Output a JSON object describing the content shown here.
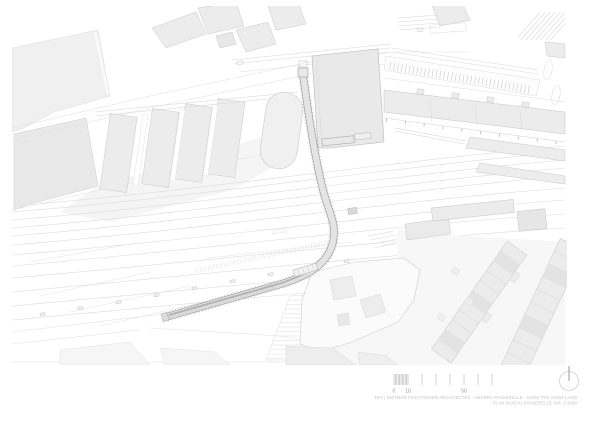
{
  "captions": {
    "line1": "DFA |  DIETMAR FEICHTINGER ARCHITECTES - ANGERS PASSERELLE - GARE TGV SAINT LAUD",
    "line2": "PLAN NIVEAU PASSERELLE éch. 1/1000"
  },
  "scale_bar": {
    "label_0": "0",
    "label_10": "10",
    "label_50": "50",
    "unit": "m"
  },
  "icons": {
    "north_indicator": "circle-with-needle"
  },
  "plan_features": [
    "passerelle footbridge with curved ramp",
    "railway tracks fanning through station",
    "station platforms",
    "station buildings",
    "parking areas with stall hatching",
    "urban housing blocks",
    "scale bar",
    "north indicator"
  ],
  "colors": {
    "paper": "#ffffff",
    "ground_light": "#f4f4f4",
    "building_fill": "#ebebeb",
    "building_stroke": "#c8c8c8",
    "track_line": "#dcdcdc",
    "bridge_deck": "#e4e4e4",
    "bridge_edge": "#9e9e9e",
    "annotation_gray": "#9c9c9c",
    "caption_gray": "#bfbfbf"
  }
}
